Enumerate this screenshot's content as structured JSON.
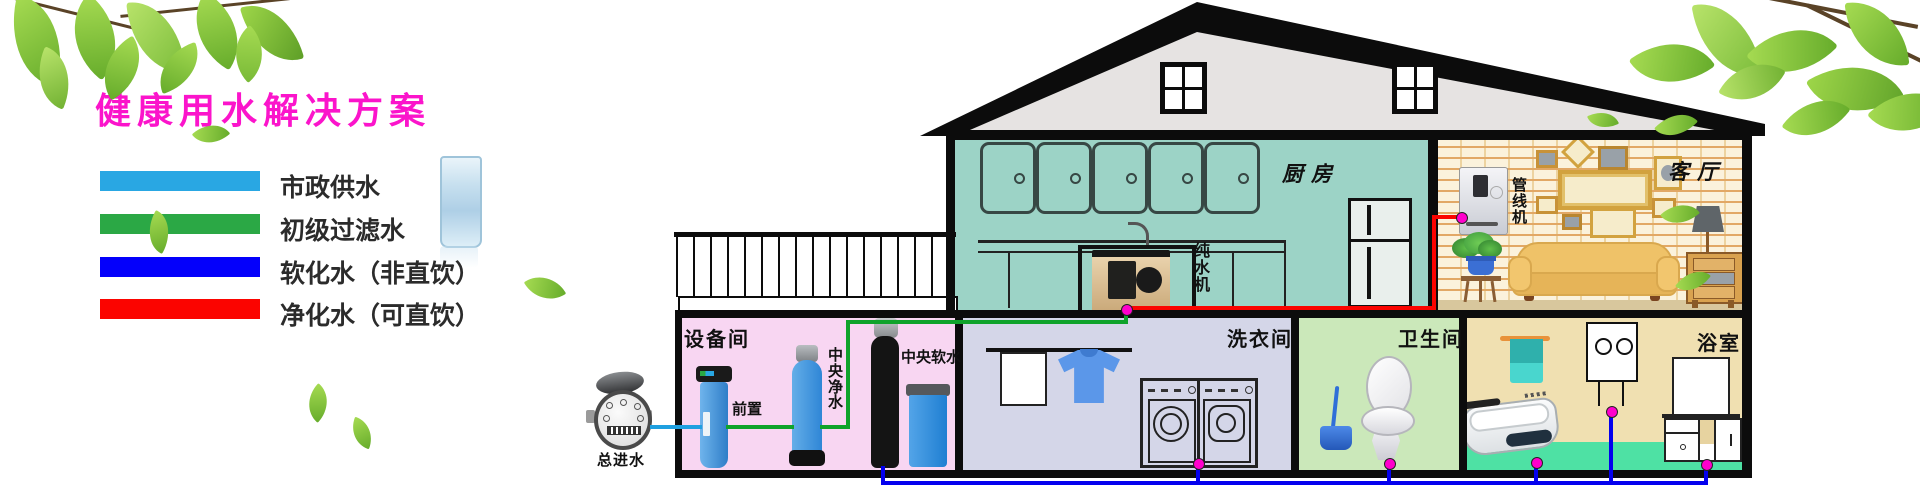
{
  "title": "健康用水解决方案",
  "legend": {
    "items": [
      {
        "label": "市政供水",
        "color": "#29A7E3"
      },
      {
        "label": "初级过滤水",
        "color": "#2BA845"
      },
      {
        "label": "软化水（非直饮）",
        "color": "#0400FB"
      },
      {
        "label": "净化水（可直饮）",
        "color": "#FB0400"
      }
    ]
  },
  "water_meter": {
    "label": "总进水"
  },
  "rooms": {
    "kitchen": {
      "label": "厨房",
      "device": "纯水机"
    },
    "living_room": {
      "label": "客厅",
      "device": "管线机"
    },
    "equipment_room": {
      "label": "设备间",
      "prefilter": "前置",
      "central_purifier": "中央净水",
      "central_softener": "中央软水"
    },
    "laundry": {
      "label": "洗衣间"
    },
    "toilet": {
      "label": "卫生间"
    },
    "bathroom": {
      "label": "浴室"
    }
  },
  "colors": {
    "title": "#FB14CB",
    "pipe_municipal": "#1FA0E0",
    "pipe_filtered": "#0FA32B",
    "pipe_softened": "#0400EE",
    "pipe_purified": "#FB0400",
    "pipe_joint": "#FF00CC",
    "kitchen_bg": "#9CD3C6",
    "equipment_bg": "#F8D6F2",
    "laundry_bg": "#D4D6E8",
    "toilet_bg": "#CBE8BA",
    "bathroom_bg": "#F0E0B1",
    "bathroom_floor": "#4EE1A4",
    "roof": "#E6E3E2"
  }
}
